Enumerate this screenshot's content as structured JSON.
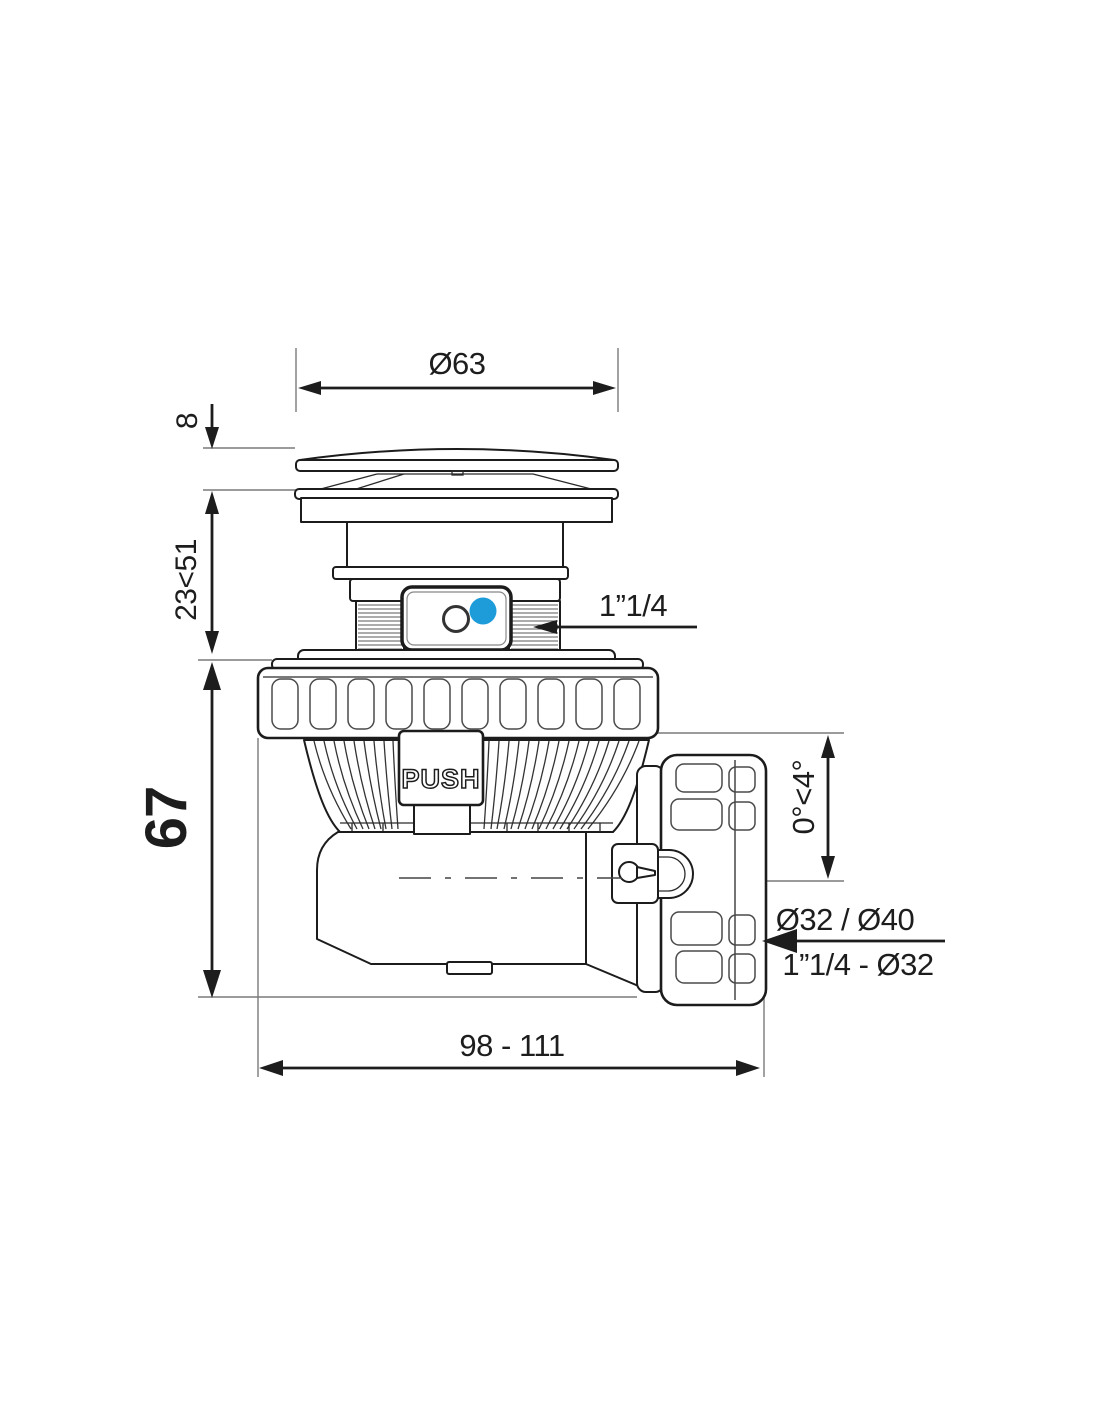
{
  "drawing": {
    "title": "Pop-up shower drain trap dimensional drawing",
    "labels": {
      "push": "PUSH"
    },
    "dimensions": {
      "cap_diameter": "Ø63",
      "cap_height": "8",
      "adjust_height": "23<51",
      "body_height": "67",
      "inlet_thread": "1”1/4",
      "outlet_angle": "0°<4°",
      "outlet_diameters": "Ø32 / Ø40",
      "outlet_thread": "1”1/4 - Ø32",
      "total_length": "98 - 111"
    },
    "colors": {
      "accent_blue": "#1E9CD9",
      "line": "#1d1d1d"
    }
  }
}
